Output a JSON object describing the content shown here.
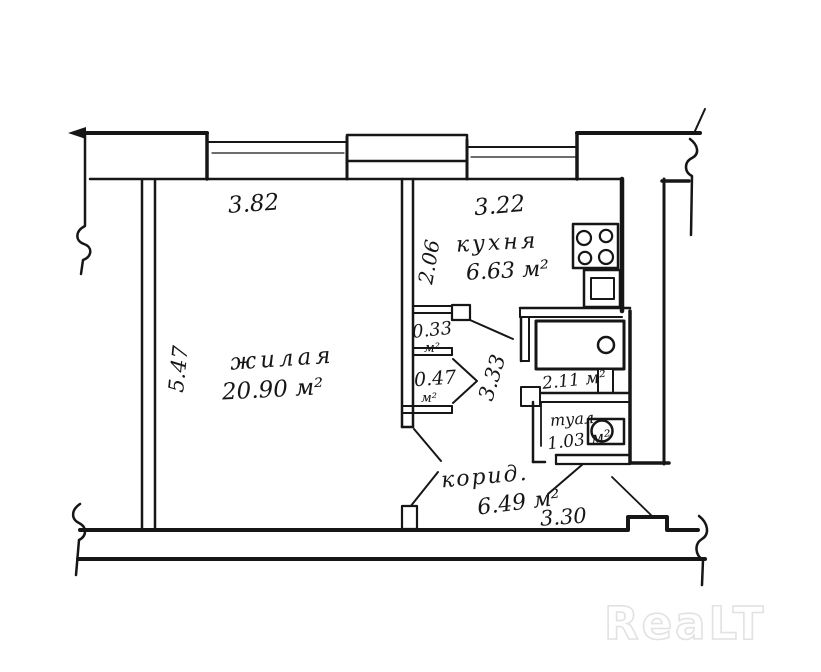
{
  "document": {
    "type": "apartment floor plan (hand-drawn BTI style)",
    "watermark": "ReaLT"
  },
  "colors": {
    "ink": "#161616",
    "paper": "#ffffff",
    "watermark_gray": "#e2e2e2"
  },
  "rooms": {
    "living": {
      "name": "жилая",
      "area": "20.90 м²"
    },
    "kitchen": {
      "name": "кухня",
      "area": "6.63 м²"
    },
    "corridor": {
      "name": "корид.",
      "area": "6.49 м²"
    },
    "toilet": {
      "name": "туал.",
      "area": "1.03 м²"
    },
    "bathroom": {
      "area": "2.11 м²"
    },
    "closet_small": {
      "area": "0.33",
      "unit": "м²"
    },
    "closet_big": {
      "area": "0.47",
      "unit": "м²"
    }
  },
  "dimensions": {
    "top_left": "3.82",
    "top_right": "3.22",
    "left": "5.47",
    "kitchen_depth": "2.06",
    "corridor": "3.33",
    "bottom": "3.30"
  },
  "fixtures": [
    {
      "icon": "stove-icon",
      "room": "kitchen"
    },
    {
      "icon": "sink-icon",
      "room": "kitchen"
    },
    {
      "icon": "bathtub-icon",
      "room": "bathroom"
    },
    {
      "icon": "toilet-icon",
      "room": "toilet"
    }
  ]
}
